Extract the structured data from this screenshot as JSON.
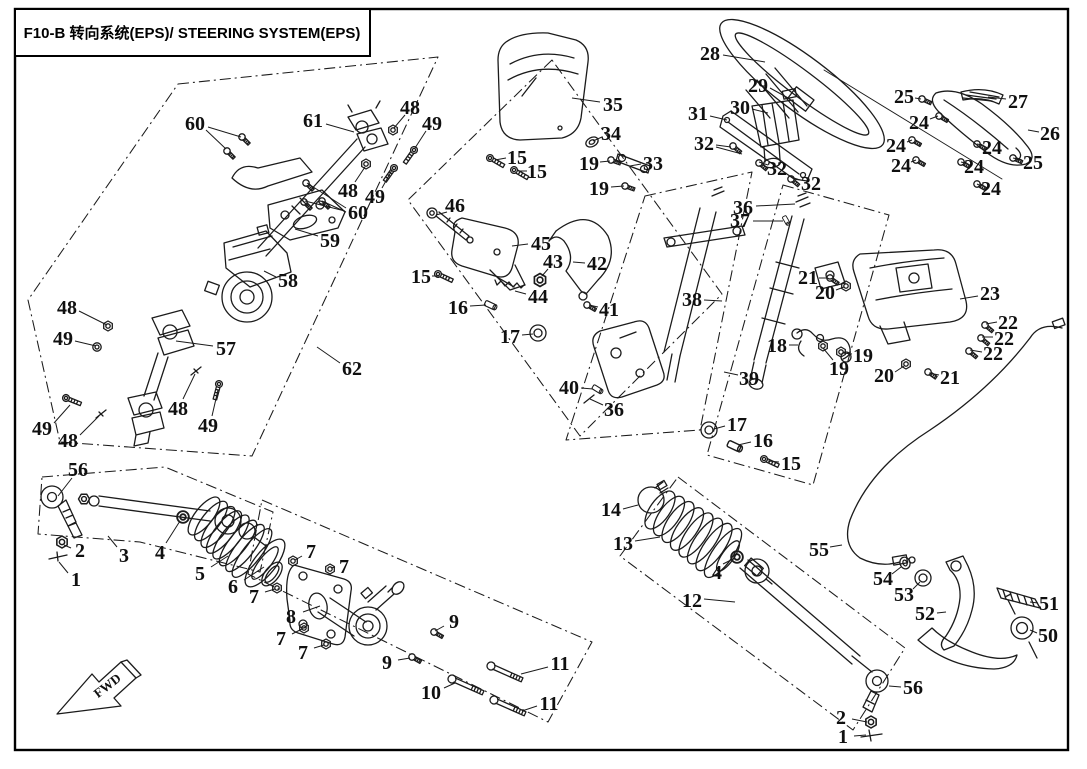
{
  "title": {
    "text": "F10-B 转向系统(EPS)/ STEERING SYSTEM(EPS)",
    "code": "F10-B",
    "name_zh": "转向系统(EPS)",
    "name_en": "STEERING SYSTEM(EPS)"
  },
  "fwd_marker": {
    "label": "FWD"
  },
  "colors": {
    "ink": "#1b1b1b",
    "background": "#ffffff"
  },
  "callouts": [
    {
      "part": "28",
      "x": 710,
      "y": 53,
      "leaders": [
        [
          723,
          55,
          765,
          62
        ]
      ]
    },
    {
      "part": "29",
      "x": 758,
      "y": 85,
      "leaders": [
        [
          770,
          88,
          790,
          99
        ]
      ]
    },
    {
      "part": "30",
      "x": 740,
      "y": 107,
      "leaders": [
        [
          752,
          109,
          768,
          113
        ]
      ]
    },
    {
      "part": "31",
      "x": 698,
      "y": 113,
      "leaders": [
        [
          710,
          116,
          727,
          120
        ]
      ]
    },
    {
      "part": "32",
      "x": 704,
      "y": 143,
      "leaders": [
        [
          716,
          145,
          731,
          147
        ],
        [
          716,
          147,
          742,
          154
        ]
      ]
    },
    {
      "part": "32",
      "x": 777,
      "y": 168,
      "leaders": [
        [
          768,
          165,
          759,
          162
        ]
      ]
    },
    {
      "part": "32",
      "x": 811,
      "y": 183,
      "leaders": [
        [
          800,
          180,
          791,
          177
        ]
      ]
    },
    {
      "part": "25",
      "x": 904,
      "y": 96,
      "leaders": [
        [
          915,
          98,
          921,
          99
        ]
      ]
    },
    {
      "part": "24",
      "x": 919,
      "y": 122,
      "leaders": [
        [
          930,
          119,
          938,
          116
        ]
      ]
    },
    {
      "part": "24",
      "x": 896,
      "y": 145,
      "leaders": [
        [
          907,
          142,
          912,
          140
        ]
      ]
    },
    {
      "part": "24",
      "x": 901,
      "y": 165,
      "leaders": [
        [
          911,
          162,
          916,
          160
        ]
      ]
    },
    {
      "part": "27",
      "x": 1018,
      "y": 101,
      "leaders": [
        [
          1006,
          99,
          988,
          97
        ]
      ]
    },
    {
      "part": "26",
      "x": 1050,
      "y": 133,
      "leaders": [
        [
          1039,
          132,
          1028,
          130
        ]
      ]
    },
    {
      "part": "24",
      "x": 992,
      "y": 147,
      "leaders": [
        [
          982,
          145,
          977,
          144
        ]
      ]
    },
    {
      "part": "24",
      "x": 974,
      "y": 166,
      "leaders": [
        [
          965,
          163,
          961,
          162
        ]
      ]
    },
    {
      "part": "25",
      "x": 1033,
      "y": 162,
      "leaders": [
        [
          1022,
          160,
          1013,
          158
        ]
      ]
    },
    {
      "part": "24",
      "x": 991,
      "y": 188,
      "leaders": [
        [
          981,
          186,
          977,
          184
        ]
      ]
    },
    {
      "part": "35",
      "x": 613,
      "y": 104,
      "leaders": [
        [
          600,
          102,
          572,
          98
        ]
      ]
    },
    {
      "part": "34",
      "x": 611,
      "y": 133,
      "leaders": [
        [
          602,
          137,
          593,
          141
        ]
      ]
    },
    {
      "part": "19",
      "x": 589,
      "y": 163,
      "leaders": [
        [
          600,
          162,
          610,
          161
        ]
      ]
    },
    {
      "part": "33",
      "x": 653,
      "y": 163,
      "leaders": [
        [
          641,
          164,
          630,
          166
        ]
      ]
    },
    {
      "part": "19",
      "x": 599,
      "y": 188,
      "leaders": [
        [
          611,
          187,
          624,
          186
        ]
      ]
    },
    {
      "part": "15",
      "x": 517,
      "y": 157,
      "leaders": [
        [
          506,
          158,
          495,
          160
        ]
      ]
    },
    {
      "part": "15",
      "x": 537,
      "y": 171,
      "leaders": [
        [
          527,
          171,
          518,
          171
        ]
      ]
    },
    {
      "part": "60",
      "x": 195,
      "y": 123,
      "leaders": [
        [
          208,
          127,
          241,
          137
        ],
        [
          206,
          130,
          226,
          149
        ]
      ]
    },
    {
      "part": "61",
      "x": 313,
      "y": 120,
      "leaders": [
        [
          326,
          124,
          354,
          132
        ]
      ]
    },
    {
      "part": "48",
      "x": 410,
      "y": 107,
      "leaders": [
        [
          405,
          115,
          394,
          128
        ]
      ]
    },
    {
      "part": "49",
      "x": 432,
      "y": 123,
      "leaders": [
        [
          426,
          131,
          415,
          148
        ]
      ]
    },
    {
      "part": "48",
      "x": 348,
      "y": 190,
      "leaders": [
        [
          355,
          182,
          365,
          167
        ]
      ]
    },
    {
      "part": "49",
      "x": 375,
      "y": 196,
      "leaders": [
        [
          382,
          188,
          392,
          170
        ]
      ]
    },
    {
      "part": "60",
      "x": 358,
      "y": 212,
      "leaders": [
        [
          346,
          208,
          307,
          183
        ],
        [
          345,
          211,
          305,
          201
        ],
        [
          346,
          212,
          322,
          201
        ]
      ]
    },
    {
      "part": "59",
      "x": 330,
      "y": 240,
      "leaders": [
        [
          318,
          236,
          295,
          229
        ]
      ]
    },
    {
      "part": "58",
      "x": 288,
      "y": 280,
      "leaders": [
        [
          276,
          277,
          264,
          271
        ]
      ]
    },
    {
      "part": "48",
      "x": 67,
      "y": 307,
      "leaders": [
        [
          79,
          311,
          107,
          325
        ]
      ]
    },
    {
      "part": "49",
      "x": 63,
      "y": 338,
      "leaders": [
        [
          75,
          341,
          96,
          346
        ]
      ]
    },
    {
      "part": "57",
      "x": 226,
      "y": 348,
      "leaders": [
        [
          213,
          346,
          176,
          341
        ]
      ]
    },
    {
      "part": "62",
      "x": 352,
      "y": 368,
      "leaders": [
        [
          340,
          363,
          317,
          347
        ]
      ]
    },
    {
      "part": "48",
      "x": 178,
      "y": 408,
      "leaders": [
        [
          183,
          399,
          195,
          374
        ]
      ]
    },
    {
      "part": "49",
      "x": 208,
      "y": 425,
      "leaders": [
        [
          212,
          416,
          218,
          390
        ]
      ]
    },
    {
      "part": "49",
      "x": 42,
      "y": 428,
      "leaders": [
        [
          54,
          423,
          70,
          405
        ]
      ]
    },
    {
      "part": "48",
      "x": 68,
      "y": 440,
      "leaders": [
        [
          80,
          435,
          99,
          416
        ]
      ]
    },
    {
      "part": "46",
      "x": 455,
      "y": 205,
      "leaders": [
        [
          447,
          212,
          436,
          215
        ]
      ]
    },
    {
      "part": "45",
      "x": 541,
      "y": 243,
      "leaders": [
        [
          528,
          244,
          512,
          246
        ]
      ]
    },
    {
      "part": "43",
      "x": 553,
      "y": 261,
      "leaders": [
        [
          548,
          269,
          542,
          276
        ]
      ]
    },
    {
      "part": "42",
      "x": 597,
      "y": 263,
      "leaders": [
        [
          585,
          263,
          573,
          262
        ]
      ]
    },
    {
      "part": "15",
      "x": 421,
      "y": 276,
      "leaders": [
        [
          432,
          276,
          439,
          276
        ]
      ]
    },
    {
      "part": "44",
      "x": 538,
      "y": 296,
      "leaders": [
        [
          526,
          294,
          515,
          291
        ]
      ]
    },
    {
      "part": "16",
      "x": 458,
      "y": 307,
      "leaders": [
        [
          470,
          306,
          486,
          305
        ]
      ]
    },
    {
      "part": "41",
      "x": 609,
      "y": 309,
      "leaders": [
        [
          598,
          307,
          589,
          305
        ]
      ]
    },
    {
      "part": "17",
      "x": 510,
      "y": 336,
      "leaders": [
        [
          522,
          335,
          533,
          334
        ]
      ]
    },
    {
      "part": "36",
      "x": 743,
      "y": 207,
      "leaders": [
        [
          756,
          206,
          795,
          204
        ]
      ]
    },
    {
      "part": "37",
      "x": 740,
      "y": 220,
      "leaders": [
        [
          753,
          221,
          783,
          221
        ]
      ]
    },
    {
      "part": "38",
      "x": 692,
      "y": 299,
      "leaders": [
        [
          704,
          300,
          722,
          301
        ]
      ]
    },
    {
      "part": "39",
      "x": 749,
      "y": 378,
      "leaders": [
        [
          738,
          375,
          724,
          372
        ]
      ]
    },
    {
      "part": "40",
      "x": 569,
      "y": 387,
      "leaders": [
        [
          581,
          388,
          593,
          389
        ]
      ]
    },
    {
      "part": "36",
      "x": 614,
      "y": 409,
      "leaders": [
        [
          603,
          405,
          590,
          399
        ]
      ]
    },
    {
      "part": "17",
      "x": 737,
      "y": 424,
      "leaders": [
        [
          725,
          426,
          714,
          429
        ]
      ]
    },
    {
      "part": "16",
      "x": 763,
      "y": 440,
      "leaders": [
        [
          751,
          442,
          738,
          445
        ]
      ]
    },
    {
      "part": "15",
      "x": 791,
      "y": 463,
      "leaders": [
        [
          779,
          462,
          768,
          461
        ]
      ]
    },
    {
      "part": "21",
      "x": 808,
      "y": 277,
      "leaders": [
        [
          819,
          278,
          827,
          278
        ]
      ]
    },
    {
      "part": "20",
      "x": 825,
      "y": 292,
      "leaders": [
        [
          836,
          290,
          844,
          287
        ]
      ]
    },
    {
      "part": "23",
      "x": 990,
      "y": 293,
      "leaders": [
        [
          978,
          296,
          960,
          299
        ]
      ]
    },
    {
      "part": "22",
      "x": 1008,
      "y": 322,
      "leaders": [
        [
          997,
          322,
          986,
          324
        ]
      ]
    },
    {
      "part": "22",
      "x": 1004,
      "y": 338,
      "leaders": [
        [
          993,
          337,
          982,
          337
        ]
      ]
    },
    {
      "part": "22",
      "x": 993,
      "y": 353,
      "leaders": [
        [
          982,
          352,
          970,
          350
        ]
      ]
    },
    {
      "part": "18",
      "x": 777,
      "y": 345,
      "leaders": [
        [
          789,
          345,
          798,
          345
        ]
      ]
    },
    {
      "part": "19",
      "x": 863,
      "y": 355,
      "leaders": [
        [
          852,
          354,
          843,
          353
        ]
      ]
    },
    {
      "part": "19",
      "x": 839,
      "y": 368,
      "leaders": [
        [
          833,
          360,
          823,
          348
        ]
      ]
    },
    {
      "part": "20",
      "x": 884,
      "y": 375,
      "leaders": [
        [
          895,
          372,
          904,
          366
        ]
      ]
    },
    {
      "part": "21",
      "x": 950,
      "y": 377,
      "leaders": [
        [
          939,
          375,
          929,
          373
        ]
      ]
    },
    {
      "part": "56",
      "x": 78,
      "y": 469,
      "leaders": [
        [
          72,
          478,
          58,
          496
        ]
      ]
    },
    {
      "part": "2",
      "x": 80,
      "y": 550,
      "leaders": [
        [
          71,
          548,
          64,
          545
        ]
      ]
    },
    {
      "part": "1",
      "x": 76,
      "y": 579,
      "leaders": [
        [
          68,
          573,
          59,
          562
        ]
      ]
    },
    {
      "part": "3",
      "x": 124,
      "y": 555,
      "leaders": [
        [
          117,
          547,
          108,
          536
        ]
      ]
    },
    {
      "part": "4",
      "x": 160,
      "y": 552,
      "leaders": [
        [
          166,
          543,
          180,
          521
        ]
      ]
    },
    {
      "part": "5",
      "x": 200,
      "y": 573,
      "leaders": [
        [
          211,
          567,
          228,
          556
        ]
      ]
    },
    {
      "part": "6",
      "x": 233,
      "y": 586,
      "leaders": [
        [
          244,
          580,
          264,
          567
        ]
      ]
    },
    {
      "part": "7",
      "x": 311,
      "y": 551,
      "leaders": [
        [
          302,
          556,
          295,
          560
        ]
      ]
    },
    {
      "part": "7",
      "x": 344,
      "y": 566,
      "leaders": [
        [
          335,
          567,
          331,
          568
        ]
      ]
    },
    {
      "part": "7",
      "x": 254,
      "y": 596,
      "leaders": [
        [
          265,
          592,
          275,
          589
        ]
      ]
    },
    {
      "part": "8",
      "x": 291,
      "y": 616,
      "leaders": [
        [
          303,
          612,
          320,
          606
        ]
      ]
    },
    {
      "part": "7",
      "x": 281,
      "y": 638,
      "leaders": [
        [
          292,
          634,
          302,
          629
        ]
      ]
    },
    {
      "part": "7",
      "x": 303,
      "y": 652,
      "leaders": [
        [
          314,
          648,
          324,
          645
        ]
      ]
    },
    {
      "part": "9",
      "x": 454,
      "y": 621,
      "leaders": [
        [
          444,
          626,
          435,
          631
        ]
      ]
    },
    {
      "part": "9",
      "x": 387,
      "y": 662,
      "leaders": [
        [
          398,
          660,
          410,
          658
        ]
      ]
    },
    {
      "part": "10",
      "x": 431,
      "y": 692,
      "leaders": [
        [
          444,
          688,
          455,
          683
        ]
      ]
    },
    {
      "part": "11",
      "x": 560,
      "y": 663,
      "leaders": [
        [
          548,
          667,
          521,
          674
        ]
      ]
    },
    {
      "part": "11",
      "x": 549,
      "y": 703,
      "leaders": [
        [
          537,
          706,
          522,
          711
        ]
      ]
    },
    {
      "part": "14",
      "x": 611,
      "y": 509,
      "leaders": [
        [
          623,
          509,
          638,
          505
        ]
      ]
    },
    {
      "part": "13",
      "x": 623,
      "y": 543,
      "leaders": [
        [
          635,
          541,
          660,
          537
        ]
      ]
    },
    {
      "part": "4",
      "x": 717,
      "y": 572,
      "leaders": [
        [
          723,
          564,
          733,
          559
        ]
      ]
    },
    {
      "part": "12",
      "x": 692,
      "y": 600,
      "leaders": [
        [
          704,
          599,
          735,
          602
        ]
      ]
    },
    {
      "part": "55",
      "x": 819,
      "y": 549,
      "leaders": [
        [
          830,
          547,
          842,
          545
        ]
      ]
    },
    {
      "part": "54",
      "x": 883,
      "y": 578,
      "leaders": [
        [
          892,
          574,
          901,
          567
        ]
      ]
    },
    {
      "part": "53",
      "x": 904,
      "y": 594,
      "leaders": [
        [
          913,
          589,
          920,
          582
        ]
      ]
    },
    {
      "part": "52",
      "x": 925,
      "y": 613,
      "leaders": [
        [
          937,
          613,
          946,
          612
        ]
      ]
    },
    {
      "part": "51",
      "x": 1049,
      "y": 603,
      "leaders": [
        [
          1038,
          603,
          1030,
          602
        ]
      ]
    },
    {
      "part": "50",
      "x": 1048,
      "y": 635,
      "leaders": [
        [
          1037,
          633,
          1030,
          630
        ]
      ]
    },
    {
      "part": "56",
      "x": 913,
      "y": 687,
      "leaders": [
        [
          901,
          687,
          889,
          686
        ]
      ]
    },
    {
      "part": "2",
      "x": 841,
      "y": 717,
      "leaders": [
        [
          852,
          719,
          867,
          722
        ]
      ]
    },
    {
      "part": "1",
      "x": 843,
      "y": 736,
      "leaders": [
        [
          854,
          736,
          866,
          735
        ]
      ]
    }
  ]
}
